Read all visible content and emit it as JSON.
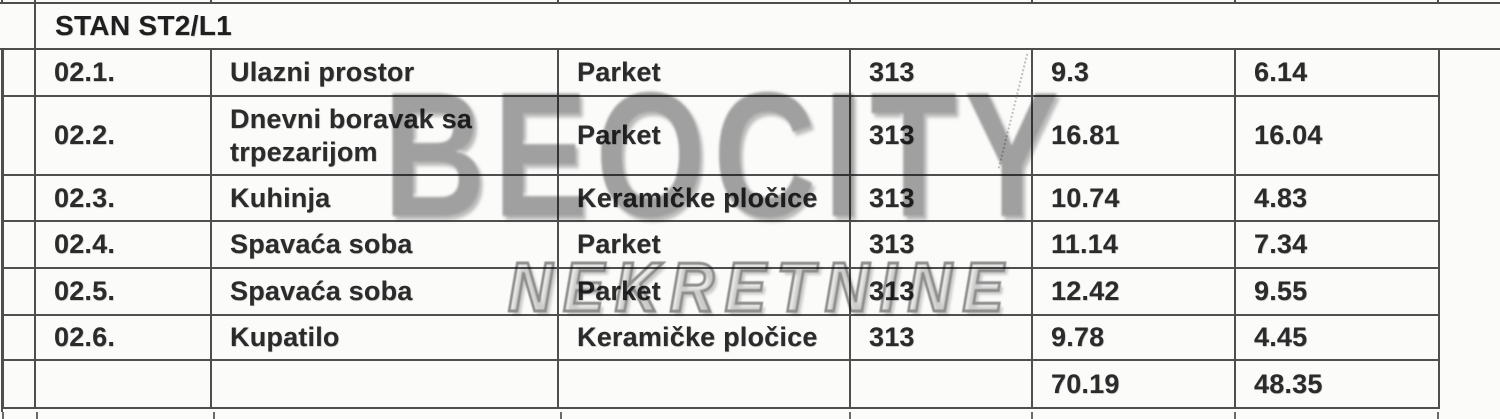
{
  "header": {
    "title": "STAN ST2/L1"
  },
  "watermark": {
    "line1": "BEOCITY",
    "line2": "NEKRETNINE"
  },
  "table": {
    "rows": [
      {
        "num": "02.1.",
        "name": "Ulazni prostor",
        "floor": "Parket",
        "code": "313",
        "area": "9.3",
        "area2": "6.14"
      },
      {
        "num": "02.2.",
        "name": "Dnevni boravak sa trpezarijom",
        "floor": "Parket",
        "code": "313",
        "area": "16.81",
        "area2": "16.04"
      },
      {
        "num": "02.3.",
        "name": "Kuhinja",
        "floor": "Keramičke pločice",
        "code": "313",
        "area": "10.74",
        "area2": "4.83"
      },
      {
        "num": "02.4.",
        "name": "Spavaća soba",
        "floor": "Parket",
        "code": "313",
        "area": "11.14",
        "area2": "7.34"
      },
      {
        "num": "02.5.",
        "name": "Spavaća soba",
        "floor": "Parket",
        "code": "313",
        "area": "12.42",
        "area2": "9.55"
      },
      {
        "num": "02.6.",
        "name": "Kupatilo",
        "floor": "Keramičke pločice",
        "code": "313",
        "area": "9.78",
        "area2": "4.45"
      }
    ],
    "totals": {
      "area": "70.19",
      "area2": "48.35"
    }
  },
  "colors": {
    "background": "#fbfbfa",
    "border": "#4f4f4f",
    "text": "#2b2b2b",
    "watermark_gray": "#a3a3a3"
  }
}
